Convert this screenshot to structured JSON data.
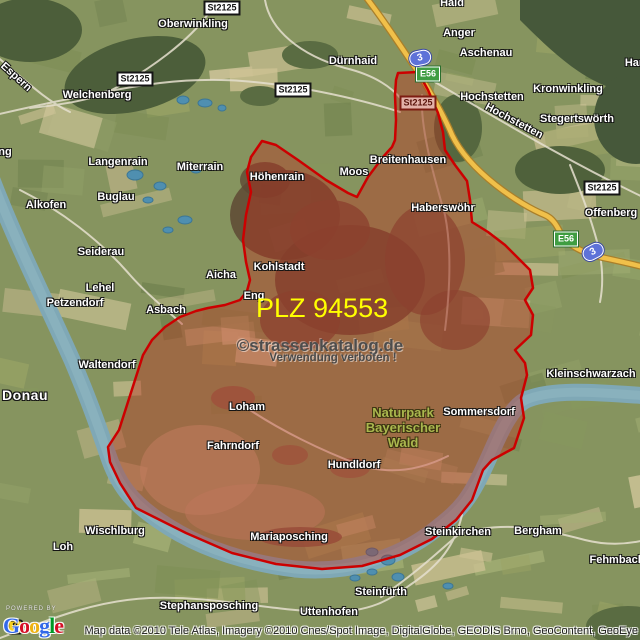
{
  "overlay": {
    "plz_text": "PLZ 94553",
    "watermark_line1": "©strassenkatalog.de",
    "watermark_line2": "Verwendung verboten !",
    "region_outline": "262,141 276,145 298,160 326,180 348,193 357,197 368,177 383,157 392,147 395,140 396,120 395,95 396,80 398,73 418,72 428,90 438,113 443,132 445,150 455,165 467,181 470,200 472,222 488,232 505,245 518,258 530,270 533,288 525,300 533,315 531,335 515,350 525,363 527,375 521,398 524,418 514,448 492,460 483,470 472,500 456,520 432,539 400,555 362,566 322,569 276,564 232,553 186,533 156,518 136,508 120,483 110,462 108,447 119,430 143,355 152,340 165,327 180,317 196,311 208,308 225,305 240,300 247,291 250,280 246,262 243,240 246,215 251,192 247,172 251,157",
    "region_fill": "rgba(190,45,30,0.4)",
    "region_stroke": "#cc0000"
  },
  "park_label": {
    "lines": [
      "Naturpark",
      "Bayerischer",
      "Wald"
    ]
  },
  "labels": [
    {
      "text": "Oberwinkling",
      "x": 193,
      "y": 24
    },
    {
      "text": "Haid",
      "x": 452,
      "y": 3
    },
    {
      "text": "Anger",
      "x": 459,
      "y": 33
    },
    {
      "text": "Aschenau",
      "x": 486,
      "y": 53
    },
    {
      "text": "Welchenberg",
      "x": 97,
      "y": 95
    },
    {
      "text": "Dürnhaid",
      "x": 353,
      "y": 61
    },
    {
      "text": "Hochstetten",
      "x": 492,
      "y": 97
    },
    {
      "text": "Kronwinkling",
      "x": 568,
      "y": 89
    },
    {
      "text": "Stegertswörth",
      "x": 577,
      "y": 119
    },
    {
      "text": "Har",
      "x": 634,
      "y": 63
    },
    {
      "text": "ng",
      "x": 5,
      "y": 152
    },
    {
      "text": "Langenrain",
      "x": 118,
      "y": 162
    },
    {
      "text": "Miterrain",
      "x": 200,
      "y": 167
    },
    {
      "text": "Höhenrain",
      "x": 277,
      "y": 177
    },
    {
      "text": "Moos",
      "x": 354,
      "y": 172
    },
    {
      "text": "Breitenhausen",
      "x": 408,
      "y": 160
    },
    {
      "text": "Haberswöhr",
      "x": 443,
      "y": 208
    },
    {
      "text": "Alkofen",
      "x": 46,
      "y": 205
    },
    {
      "text": "Buglau",
      "x": 116,
      "y": 197
    },
    {
      "text": "Seiderau",
      "x": 101,
      "y": 252
    },
    {
      "text": "Lehel",
      "x": 100,
      "y": 288
    },
    {
      "text": "Petzendorf",
      "x": 75,
      "y": 303
    },
    {
      "text": "Asbach",
      "x": 166,
      "y": 310
    },
    {
      "text": "Aicha",
      "x": 221,
      "y": 275
    },
    {
      "text": "Kohlstadt",
      "x": 279,
      "y": 267
    },
    {
      "text": "Eng",
      "x": 254,
      "y": 296
    },
    {
      "text": "Offenberg",
      "x": 611,
      "y": 213
    },
    {
      "text": "Waltendorf",
      "x": 107,
      "y": 365
    },
    {
      "text": "Kleinschwarzach",
      "x": 591,
      "y": 374
    },
    {
      "text": "Sommersdorf",
      "x": 479,
      "y": 412
    },
    {
      "text": "Loham",
      "x": 247,
      "y": 407
    },
    {
      "text": "Fahrndorf",
      "x": 233,
      "y": 446
    },
    {
      "text": "Hundldorf",
      "x": 354,
      "y": 465
    },
    {
      "text": "Wischlburg",
      "x": 115,
      "y": 531
    },
    {
      "text": "Loh",
      "x": 63,
      "y": 547
    },
    {
      "text": "Mariaposching",
      "x": 289,
      "y": 537
    },
    {
      "text": "Steinkirchen",
      "x": 458,
      "y": 532
    },
    {
      "text": "Bergham",
      "x": 538,
      "y": 531
    },
    {
      "text": "Fehmbach",
      "x": 617,
      "y": 560
    },
    {
      "text": "Steinfürth",
      "x": 381,
      "y": 592
    },
    {
      "text": "Stephansposching",
      "x": 209,
      "y": 606
    },
    {
      "text": "Uttenhofen",
      "x": 329,
      "y": 612
    },
    {
      "text": "Donau",
      "x": 25,
      "y": 395,
      "cls": "water"
    },
    {
      "text": "Espern",
      "x": 16,
      "y": 77,
      "rot": 42,
      "cls": "roadname"
    },
    {
      "text": "Hochstetten",
      "x": 514,
      "y": 121,
      "rot": 28,
      "cls": "roadname"
    }
  ],
  "badges": [
    {
      "text": "St2125",
      "style": "state",
      "x": 222,
      "y": 8
    },
    {
      "text": "St2125",
      "style": "state",
      "x": 135,
      "y": 79
    },
    {
      "text": "St2125",
      "style": "state",
      "x": 293,
      "y": 90
    },
    {
      "text": "St2125",
      "style": "state",
      "x": 602,
      "y": 188
    },
    {
      "text": "St2125",
      "style": "state tinted",
      "x": 418,
      "y": 103
    },
    {
      "text": "E56",
      "style": "euro",
      "x": 428,
      "y": 74
    },
    {
      "text": "E56",
      "style": "euro",
      "x": 566,
      "y": 239
    },
    {
      "text": "3",
      "style": "autobahn",
      "x": 420,
      "y": 58,
      "rot": -12
    },
    {
      "text": "3",
      "style": "autobahn",
      "x": 593,
      "y": 252,
      "rot": -28
    },
    {
      "text": "8",
      "style": "bundes",
      "x": 15,
      "y": 627
    }
  ],
  "footer": {
    "powered_by": "POWERED BY",
    "logo_letters": [
      {
        "ch": "G",
        "color": "#3369E8"
      },
      {
        "ch": "o",
        "color": "#D50F25"
      },
      {
        "ch": "o",
        "color": "#EEB211"
      },
      {
        "ch": "g",
        "color": "#3369E8"
      },
      {
        "ch": "l",
        "color": "#009925"
      },
      {
        "ch": "e",
        "color": "#D50F25"
      }
    ],
    "attribution": "Map data ©2010 Tele Atlas, Imagery ©2010 Cnes/Spot Image, DigitalGlobe, GEODIS Brno, GeoContent, GeoEye"
  }
}
